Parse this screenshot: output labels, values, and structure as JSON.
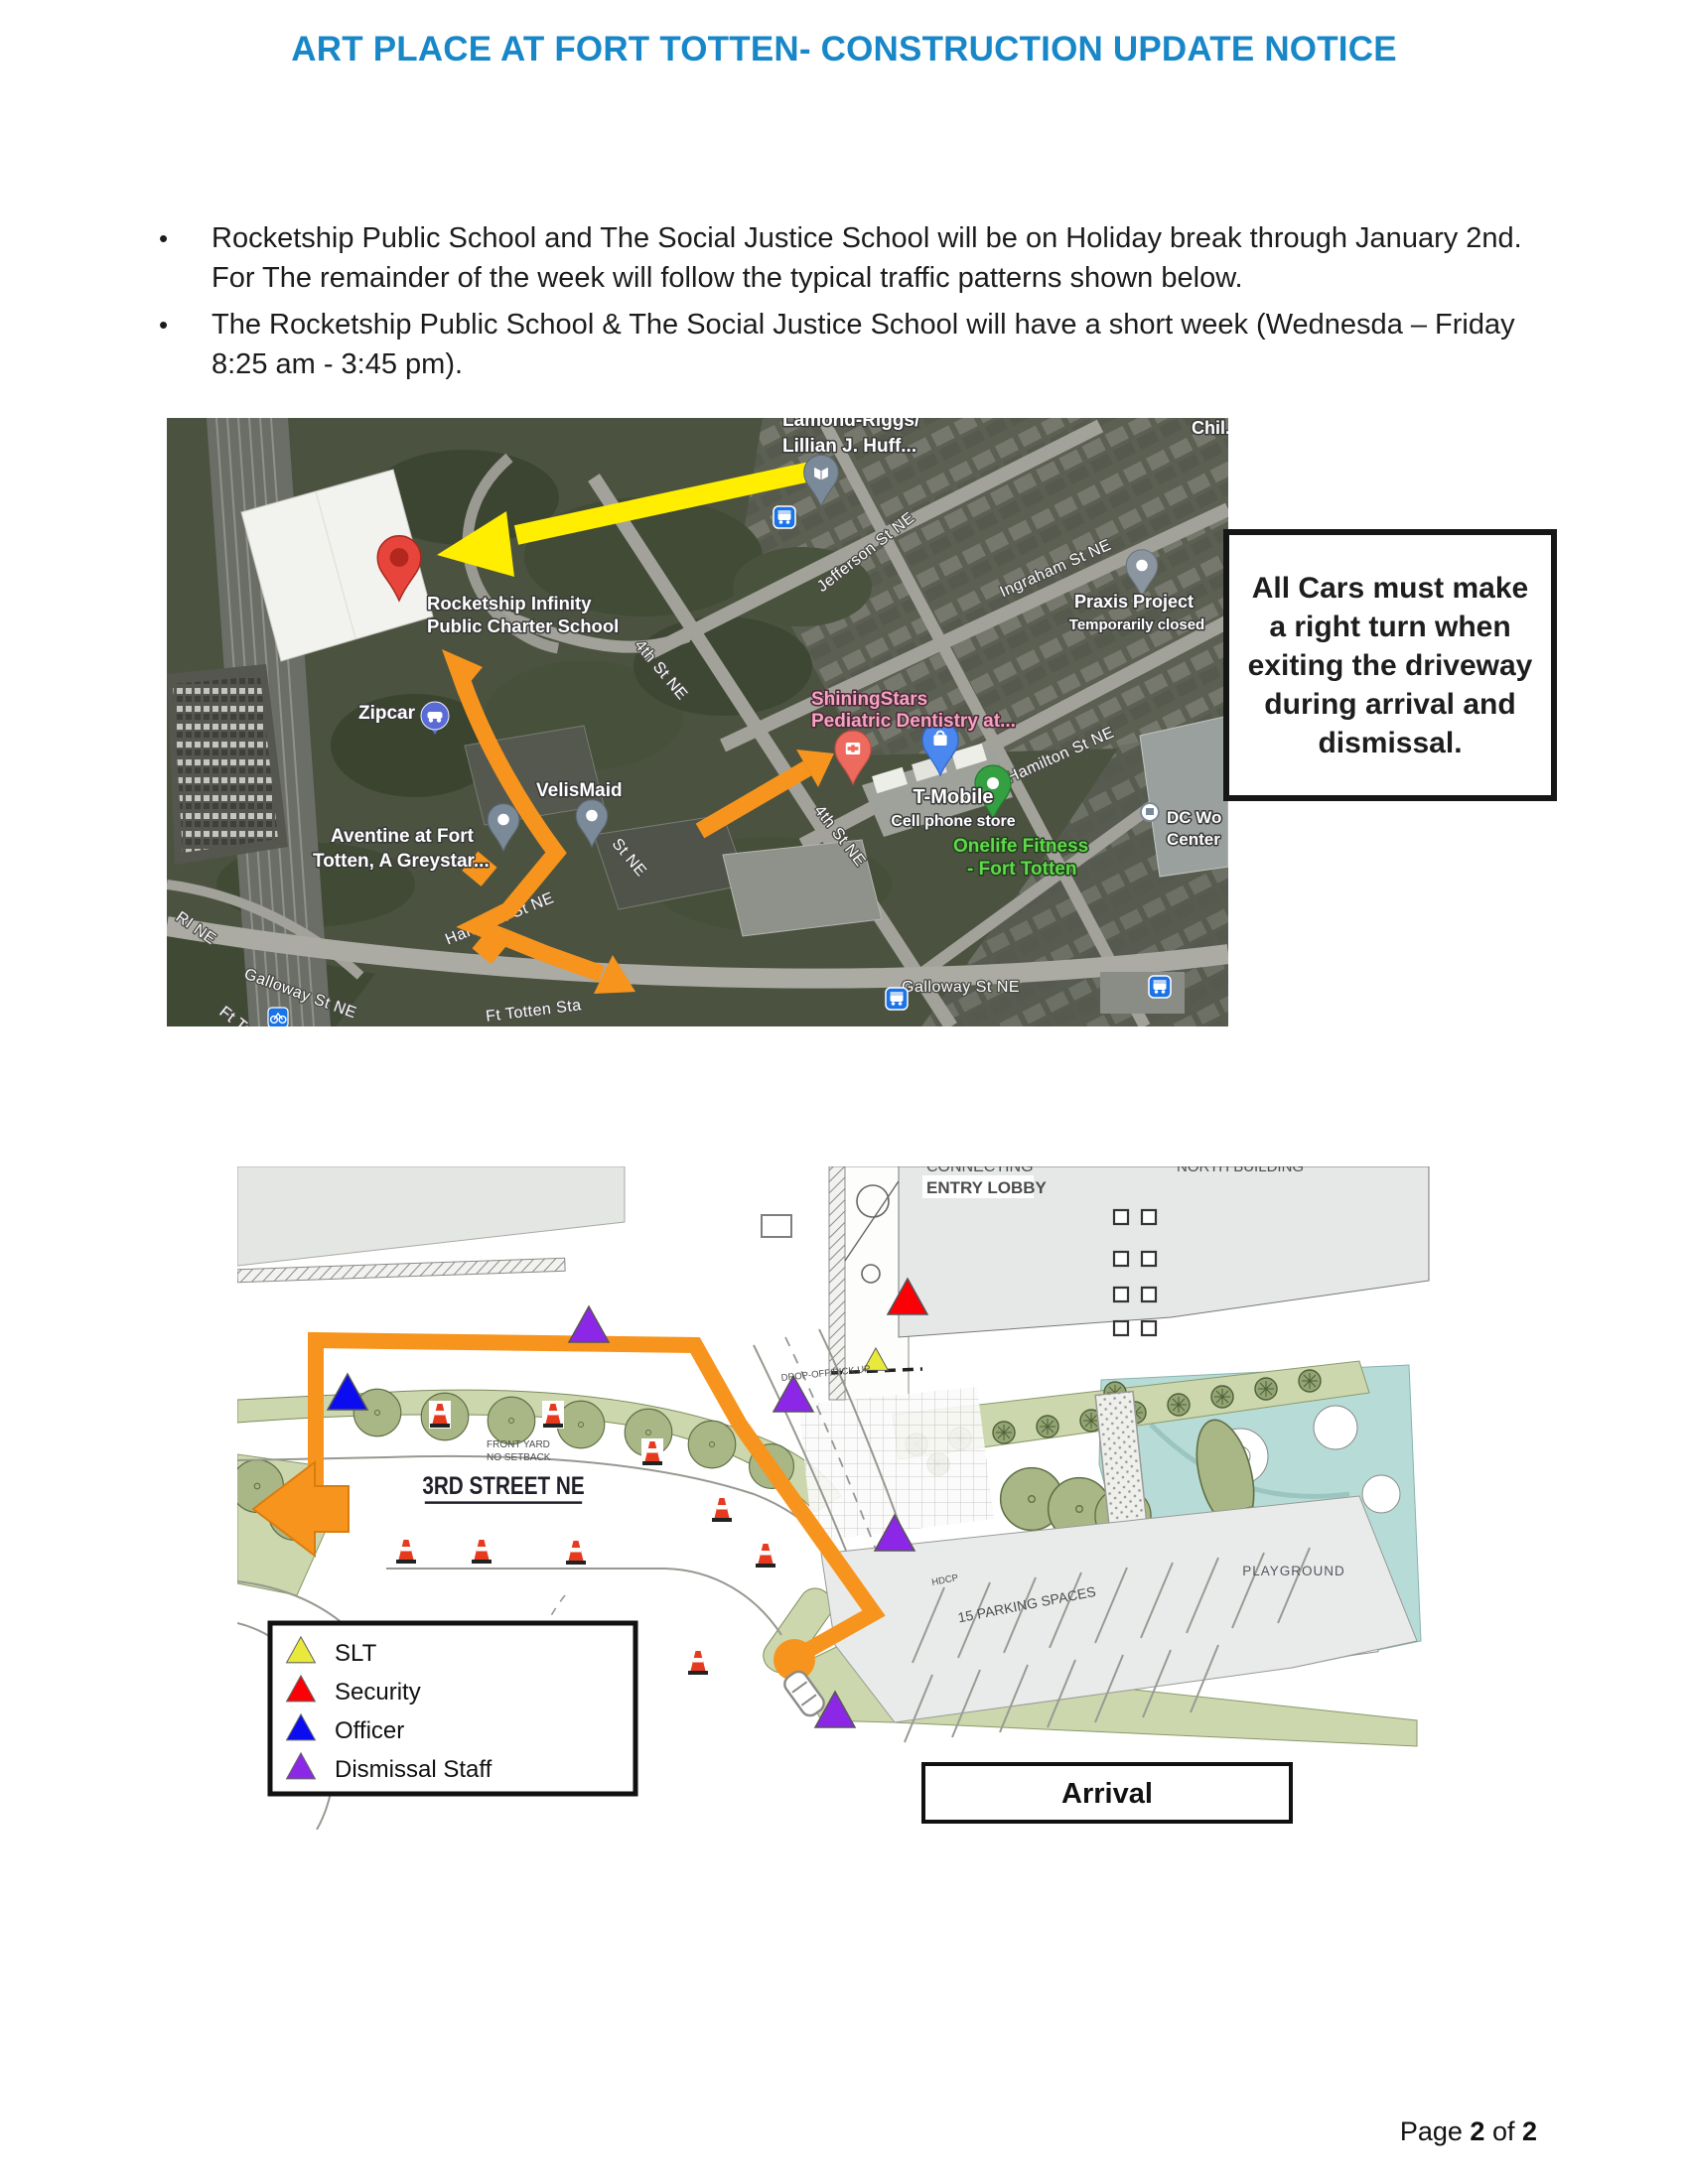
{
  "page": {
    "title": "ART PLACE AT FORT TOTTEN- CONSTRUCTION UPDATE NOTICE",
    "footer": {
      "prefix": "Page ",
      "page_num": "2",
      "middle": " of ",
      "total": "2"
    }
  },
  "bullets": {
    "marker": "•",
    "item1": "Rocketship Public School and The Social Justice School will be on Holiday break through January 2nd. For The remainder of the week will follow the typical traffic patterns shown below.",
    "item2": "The Rocketship Public School & The Social Justice School will have a short week (Wednesda – Friday 8:25 am - 3:45 pm)."
  },
  "colors": {
    "title_blue": "#1887c8",
    "route_orange": "#f7941d",
    "highlight_yellow": "#ffee00",
    "pin_red": "#e7453c",
    "playground_teal": "#b7dcd8"
  },
  "map": {
    "callout": "All Cars must make a right turn when exiting the driveway during arrival and dismissal.",
    "labels": {
      "lamond": "Lamond-Riggs/",
      "lillian": "Lillian J. Huff...",
      "chil": "Chil...",
      "jefferson": "Jefferson St NE",
      "ingraham": "Ingraham St NE",
      "praxis_1": "Praxis Project",
      "praxis_2": "Temporarily closed",
      "rocketship_1": "Rocketship Infinity",
      "rocketship_2": "Public Charter School",
      "zipcar": "Zipcar",
      "fourth_upper": "4th St NE",
      "fourth_lower": "4th St NE",
      "partial_st": "St NE",
      "shining_1": "ShiningStars",
      "shining_2": "Pediatric Dentistry at...",
      "velismaid": "VelisMaid",
      "tmobile_1": "T-Mobile",
      "tmobile_2": "Cell phone store",
      "onelife_1": "Onelife Fitness",
      "onelife_2": "- Fort Totten",
      "hamilton": "Hamilton St NE",
      "hamilton_partial": "Hamilton St NE",
      "dc_1": "DC Wo",
      "dc_2": "Center",
      "aventine_1": "Aventine at Fort",
      "aventine_2": "Totten, A Greystar...",
      "galloway_left": "Galloway St NE",
      "galloway_right": "Galloway St NE",
      "ri": "RI NE",
      "ft_to": "Ft To",
      "ft_totten_sta": "Ft Totten Sta"
    }
  },
  "siteplan": {
    "labels": {
      "connecting": "CONNECTING",
      "entry_lobby": "ENTRY LOBBY",
      "north_building": "NORTH BUILDING",
      "street": "3RD STREET NE",
      "front_yard_1": "FRONT YARD",
      "front_yard_2": "NO SETBACK",
      "dropoff": "DROP-OFF/PICK UP",
      "hdcp": "HDCP",
      "parking": "15 PARKING SPACES",
      "playground": "PLAYGROUND",
      "arrival": "Arrival"
    },
    "legend": {
      "items": [
        {
          "label": "SLT",
          "color": "#e9e93c"
        },
        {
          "label": "Security",
          "color": "#fb0006"
        },
        {
          "label": "Officer",
          "color": "#0c0cf0"
        },
        {
          "label": "Dismissal Staff",
          "color": "#8d27e8"
        }
      ]
    }
  }
}
